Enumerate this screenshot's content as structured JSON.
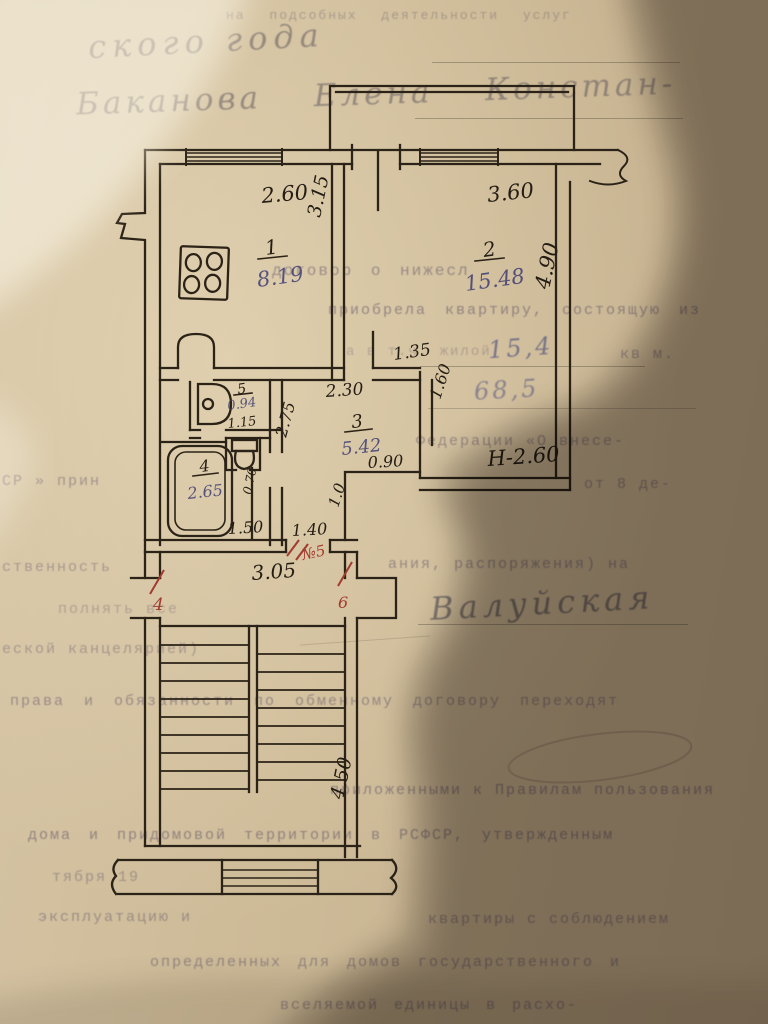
{
  "handwriting": {
    "top_line_1": "ского года",
    "top_line_2": "Баканова Елена Констан-",
    "living_area": "15,4",
    "total_area": "68,5",
    "signature": "Валуйская"
  },
  "typed_lines": [
    {
      "text": "на подсобных деятельности услуг"
    },
    {
      "text": "договор о нижесл"
    },
    {
      "text": "приобрела квартиру, состоящую из"
    },
    {
      "text": "а в т.ч. жилой"
    },
    {
      "text": "кв м."
    },
    {
      "text": "Федерации «О внесе-"
    },
    {
      "text": "СР » прин"
    },
    {
      "text": "от 8 де-"
    },
    {
      "text": "ственность"
    },
    {
      "text": "ания, распоряжения) на"
    },
    {
      "text": "полнять все"
    },
    {
      "text": "еской канцелярией)"
    },
    {
      "text": "права и обязанности по обменному договору переходят"
    },
    {
      "text": "приложенными к Правилам пользования"
    },
    {
      "text": "дома и придомовой территории в РСФСР, утвержденным"
    },
    {
      "text": "тября 19"
    },
    {
      "text": "эксплуатацию и"
    },
    {
      "text": "квартиры с соблюдением"
    },
    {
      "text": "определенных для домов государственного и"
    },
    {
      "text": "вселяемой единицы в расхо-"
    }
  ],
  "plan": {
    "rooms": [
      {
        "number": "1",
        "area": "8.19"
      },
      {
        "number": "2",
        "area": "15.48"
      },
      {
        "number": "3",
        "area": "5.42"
      },
      {
        "number": "4",
        "area": "2.65"
      },
      {
        "number": "5",
        "area": "0.94"
      }
    ],
    "dimensions": {
      "kitchen_width": "2.60",
      "kitchen_depth": "3.15",
      "room2_width": "3.60",
      "room2_depth": "4.90",
      "hall_top": "1.35",
      "hall_width": "2.30",
      "hall_right": "1.60",
      "hall_bottom": "0.90",
      "corridor_depth": "2.75",
      "wc_width": "1.15",
      "toilet_width": "0.70",
      "bath_width": "1.50",
      "entry_width": "1.40",
      "entry_depth": "1.0",
      "landing_width": "3.05",
      "stairs_depth": "4.50"
    },
    "height_note": "Н-2.60",
    "red_marks": {
      "left_door": "4",
      "entry_door": "№5",
      "right_door": "6"
    }
  }
}
